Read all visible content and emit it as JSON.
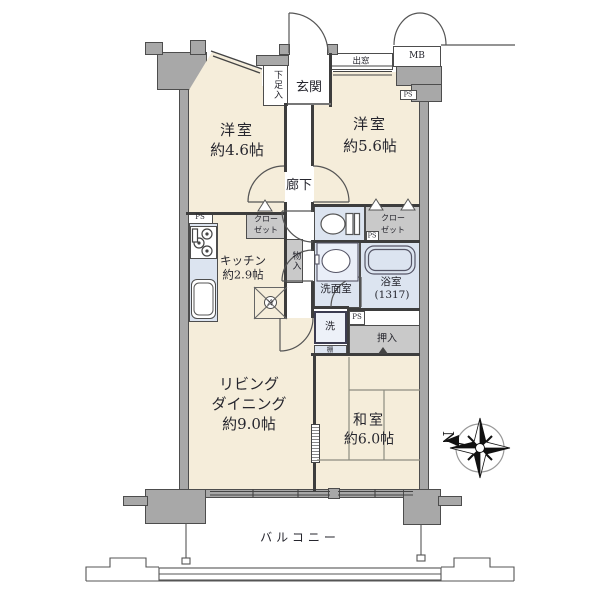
{
  "colors": {
    "floor": "#f5edda",
    "wet_area": "#dce4f0",
    "storage": "#c9c9c9",
    "wall": "#a8a8a8",
    "line": "#3d3d3d",
    "text": "#26262e"
  },
  "rooms": {
    "western_room_1": {
      "name": "洋室",
      "size": "約4.6帖"
    },
    "western_room_2": {
      "name": "洋室",
      "size": "約5.6帖"
    },
    "living_dining": {
      "name1": "リビング",
      "name2": "ダイニング",
      "size": "約9.0帖"
    },
    "kitchen": {
      "name": "キッチン",
      "size": "約2.9帖"
    },
    "japanese_room": {
      "name": "和室",
      "size": "約6.0帖"
    },
    "hallway": {
      "name": "廊下"
    },
    "entrance": {
      "name": "玄関"
    },
    "washroom": {
      "name": "洗面室"
    },
    "bathroom": {
      "name": "浴室",
      "size": "(1317)"
    },
    "balcony": {
      "name": "バルコニー"
    }
  },
  "features": {
    "shoe_cabinet": "下足入",
    "bay_window": "出窓",
    "meter_box": "MB",
    "pipe_space": "PS",
    "closet_line1": "クロー",
    "closet_line2": "ゼット",
    "storage_closet": "物入",
    "futon_closet": "押入",
    "washing_machine": "洗",
    "shelf": "棚",
    "refrigerator": "冷"
  },
  "compass": {
    "north": "N"
  }
}
